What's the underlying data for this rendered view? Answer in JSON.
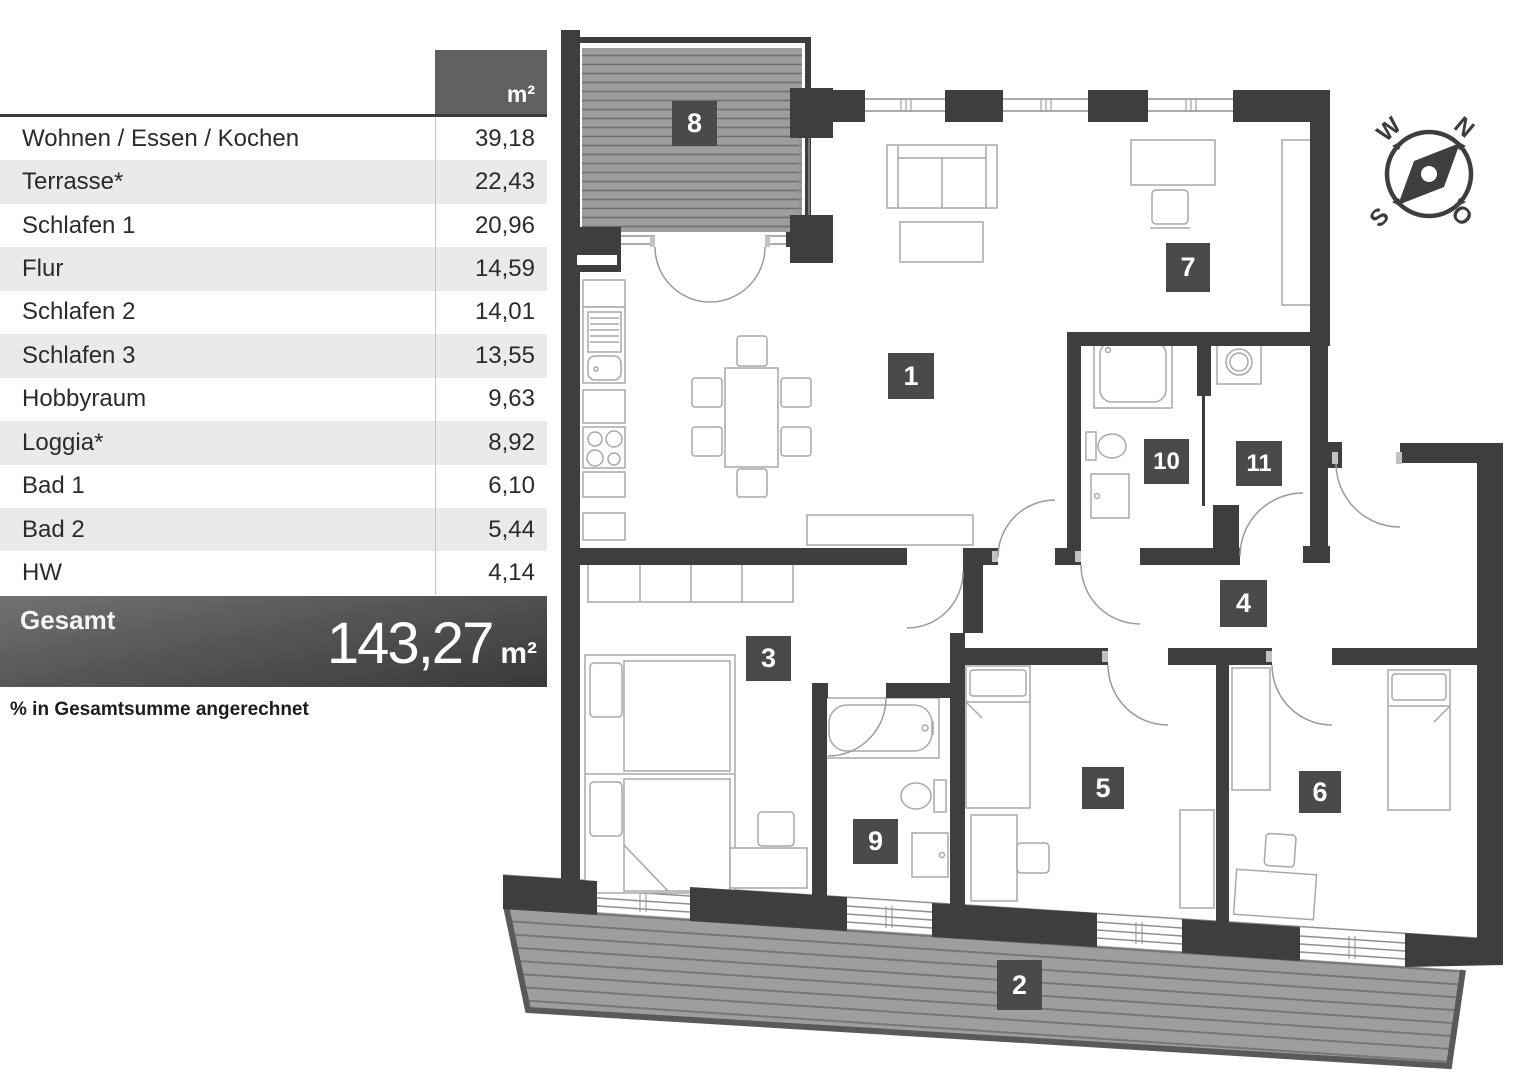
{
  "table": {
    "unit_header": "m²",
    "rows": [
      {
        "name": "Wohnen / Essen / Kochen",
        "value": "39,18"
      },
      {
        "name": "Terrasse*",
        "value": "22,43"
      },
      {
        "name": "Schlafen 1",
        "value": "20,96"
      },
      {
        "name": "Flur",
        "value": "14,59"
      },
      {
        "name": "Schlafen 2",
        "value": "14,01"
      },
      {
        "name": "Schlafen 3",
        "value": "13,55"
      },
      {
        "name": "Hobbyraum",
        "value": "9,63"
      },
      {
        "name": "Loggia*",
        "value": "8,92"
      },
      {
        "name": "Bad 1",
        "value": "6,10"
      },
      {
        "name": "Bad 2",
        "value": "5,44"
      },
      {
        "name": "HW",
        "value": "4,14"
      }
    ],
    "total": {
      "label": "Gesamt",
      "value": "143,27",
      "unit": "m²"
    },
    "footnote": "% in Gesamtsumme angerechnet"
  },
  "plan": {
    "room_labels": [
      "1",
      "2",
      "3",
      "4",
      "5",
      "6",
      "7",
      "8",
      "9",
      "10",
      "11"
    ],
    "compass": {
      "north": "N",
      "east": "O",
      "south": "S",
      "west": "W"
    }
  },
  "colors": {
    "wall": "#3e3e41",
    "label_box": "#4a4a4d",
    "deck": "#9d9d9d",
    "table_header": "#606060",
    "row_alt": "#eaeaea",
    "total_bar": "#3a3a3a"
  }
}
